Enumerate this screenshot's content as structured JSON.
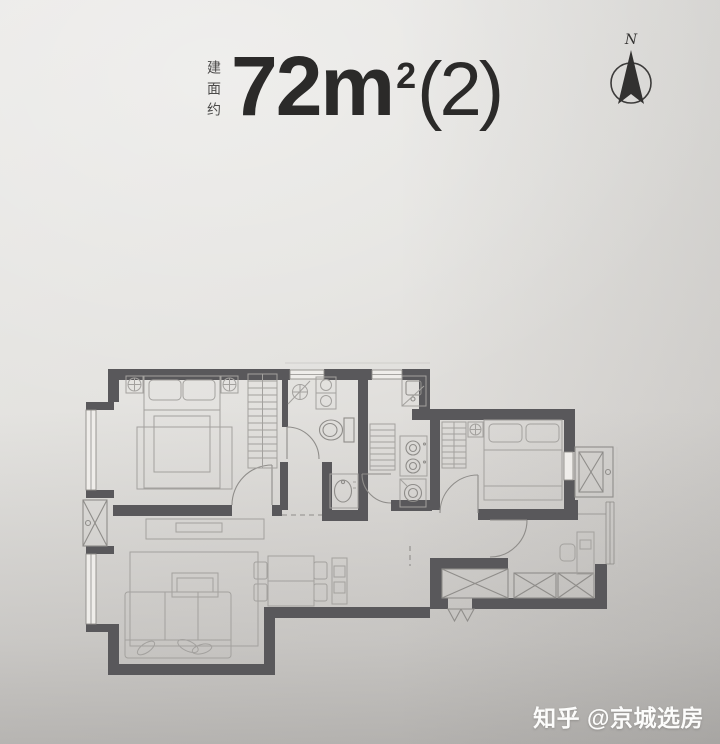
{
  "header": {
    "area_label_vertical": "建面约",
    "area_value": "72m",
    "area_superscript": "2",
    "area_suffix": "(2)"
  },
  "compass": {
    "label": "N"
  },
  "watermark": {
    "text": "知乎 @京城选房"
  },
  "colors": {
    "wall": "#59585b",
    "furniture-line": "#a3a19e",
    "fixture-line": "#8f8d8a",
    "paper-light": "#efedea",
    "title-text": "#2b2a29",
    "label-text": "#4b4a49",
    "watermark-text": "#fcfcfb"
  },
  "floor_plan": {
    "type": "apartment-floor-plan",
    "features": [
      "master-bedroom",
      "living-dining-room",
      "bathroom",
      "kitchen",
      "second-bedroom",
      "study",
      "entry-hall",
      "storage-closet",
      "ac-platform",
      "shaft",
      "bay-windows"
    ]
  }
}
